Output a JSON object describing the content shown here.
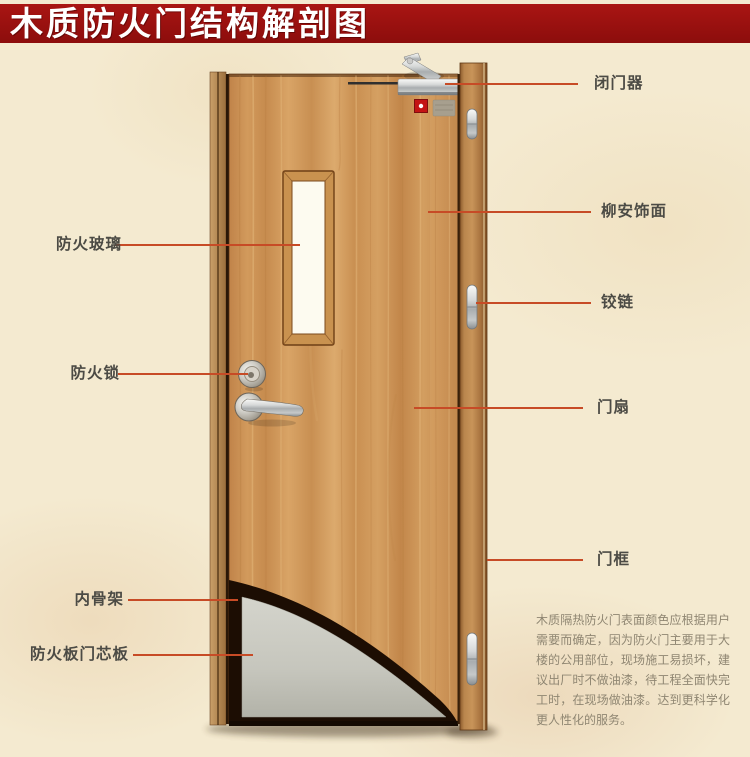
{
  "title": "木质防火门结构解剖图",
  "labels": {
    "door_closer": "闭门器",
    "lauan_veneer": "柳安饰面",
    "hinge": "铰链",
    "door_leaf": "门扇",
    "door_frame": "门框",
    "fire_glass": "防火玻璃",
    "fire_lock": "防火锁",
    "inner_skeleton": "内骨架",
    "fire_board_core": "防火板门芯板"
  },
  "description": "木质隔热防火门表面颜色应根据用户需要而确定，因为防火门主要用于大楼的公用部位，现场施工易损坏，建议出厂时不做油漆，待工程全面快完工时，在现场做油漆。达到更科学化更人性化的服务。",
  "colors": {
    "banner_red": "#9c100e",
    "leader_line": "#c74b26",
    "label_text": "#4c4b45",
    "description_text": "#8f8672",
    "background_parchment": "#f4ead0",
    "door_wood": "#cf9457",
    "core_gray": "#c6c6bd"
  }
}
